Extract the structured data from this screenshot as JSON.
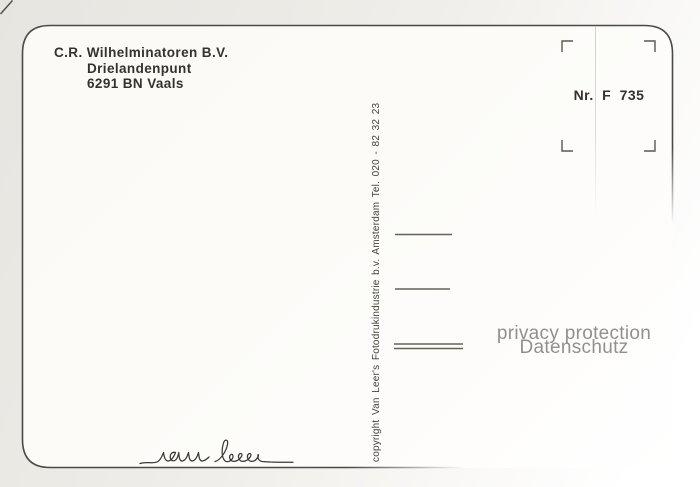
{
  "sender": {
    "line1": "C.R. Wilhelminatoren B.V.",
    "line2": "Drielandenpunt",
    "line3": "6291 BN Vaals"
  },
  "stamp": {
    "number": "Nr. F 735"
  },
  "copyright_line": "copyright Van Leer's Fotodrukindustrie b.v. Amsterdam Tel. 020 - 82 32 23",
  "signature": "van leer",
  "watermark": {
    "line1": "privacy protection",
    "line2": "Datenschutz"
  },
  "address_rules": {
    "count": 3,
    "note": "third rule is doubled"
  },
  "colors": {
    "ink": "#34322e",
    "border": "#4b4945",
    "rule_line": "#63615a",
    "watermark": "#878787",
    "card_bg": "#fcfbf8",
    "page_bg": "#eae8e3"
  }
}
